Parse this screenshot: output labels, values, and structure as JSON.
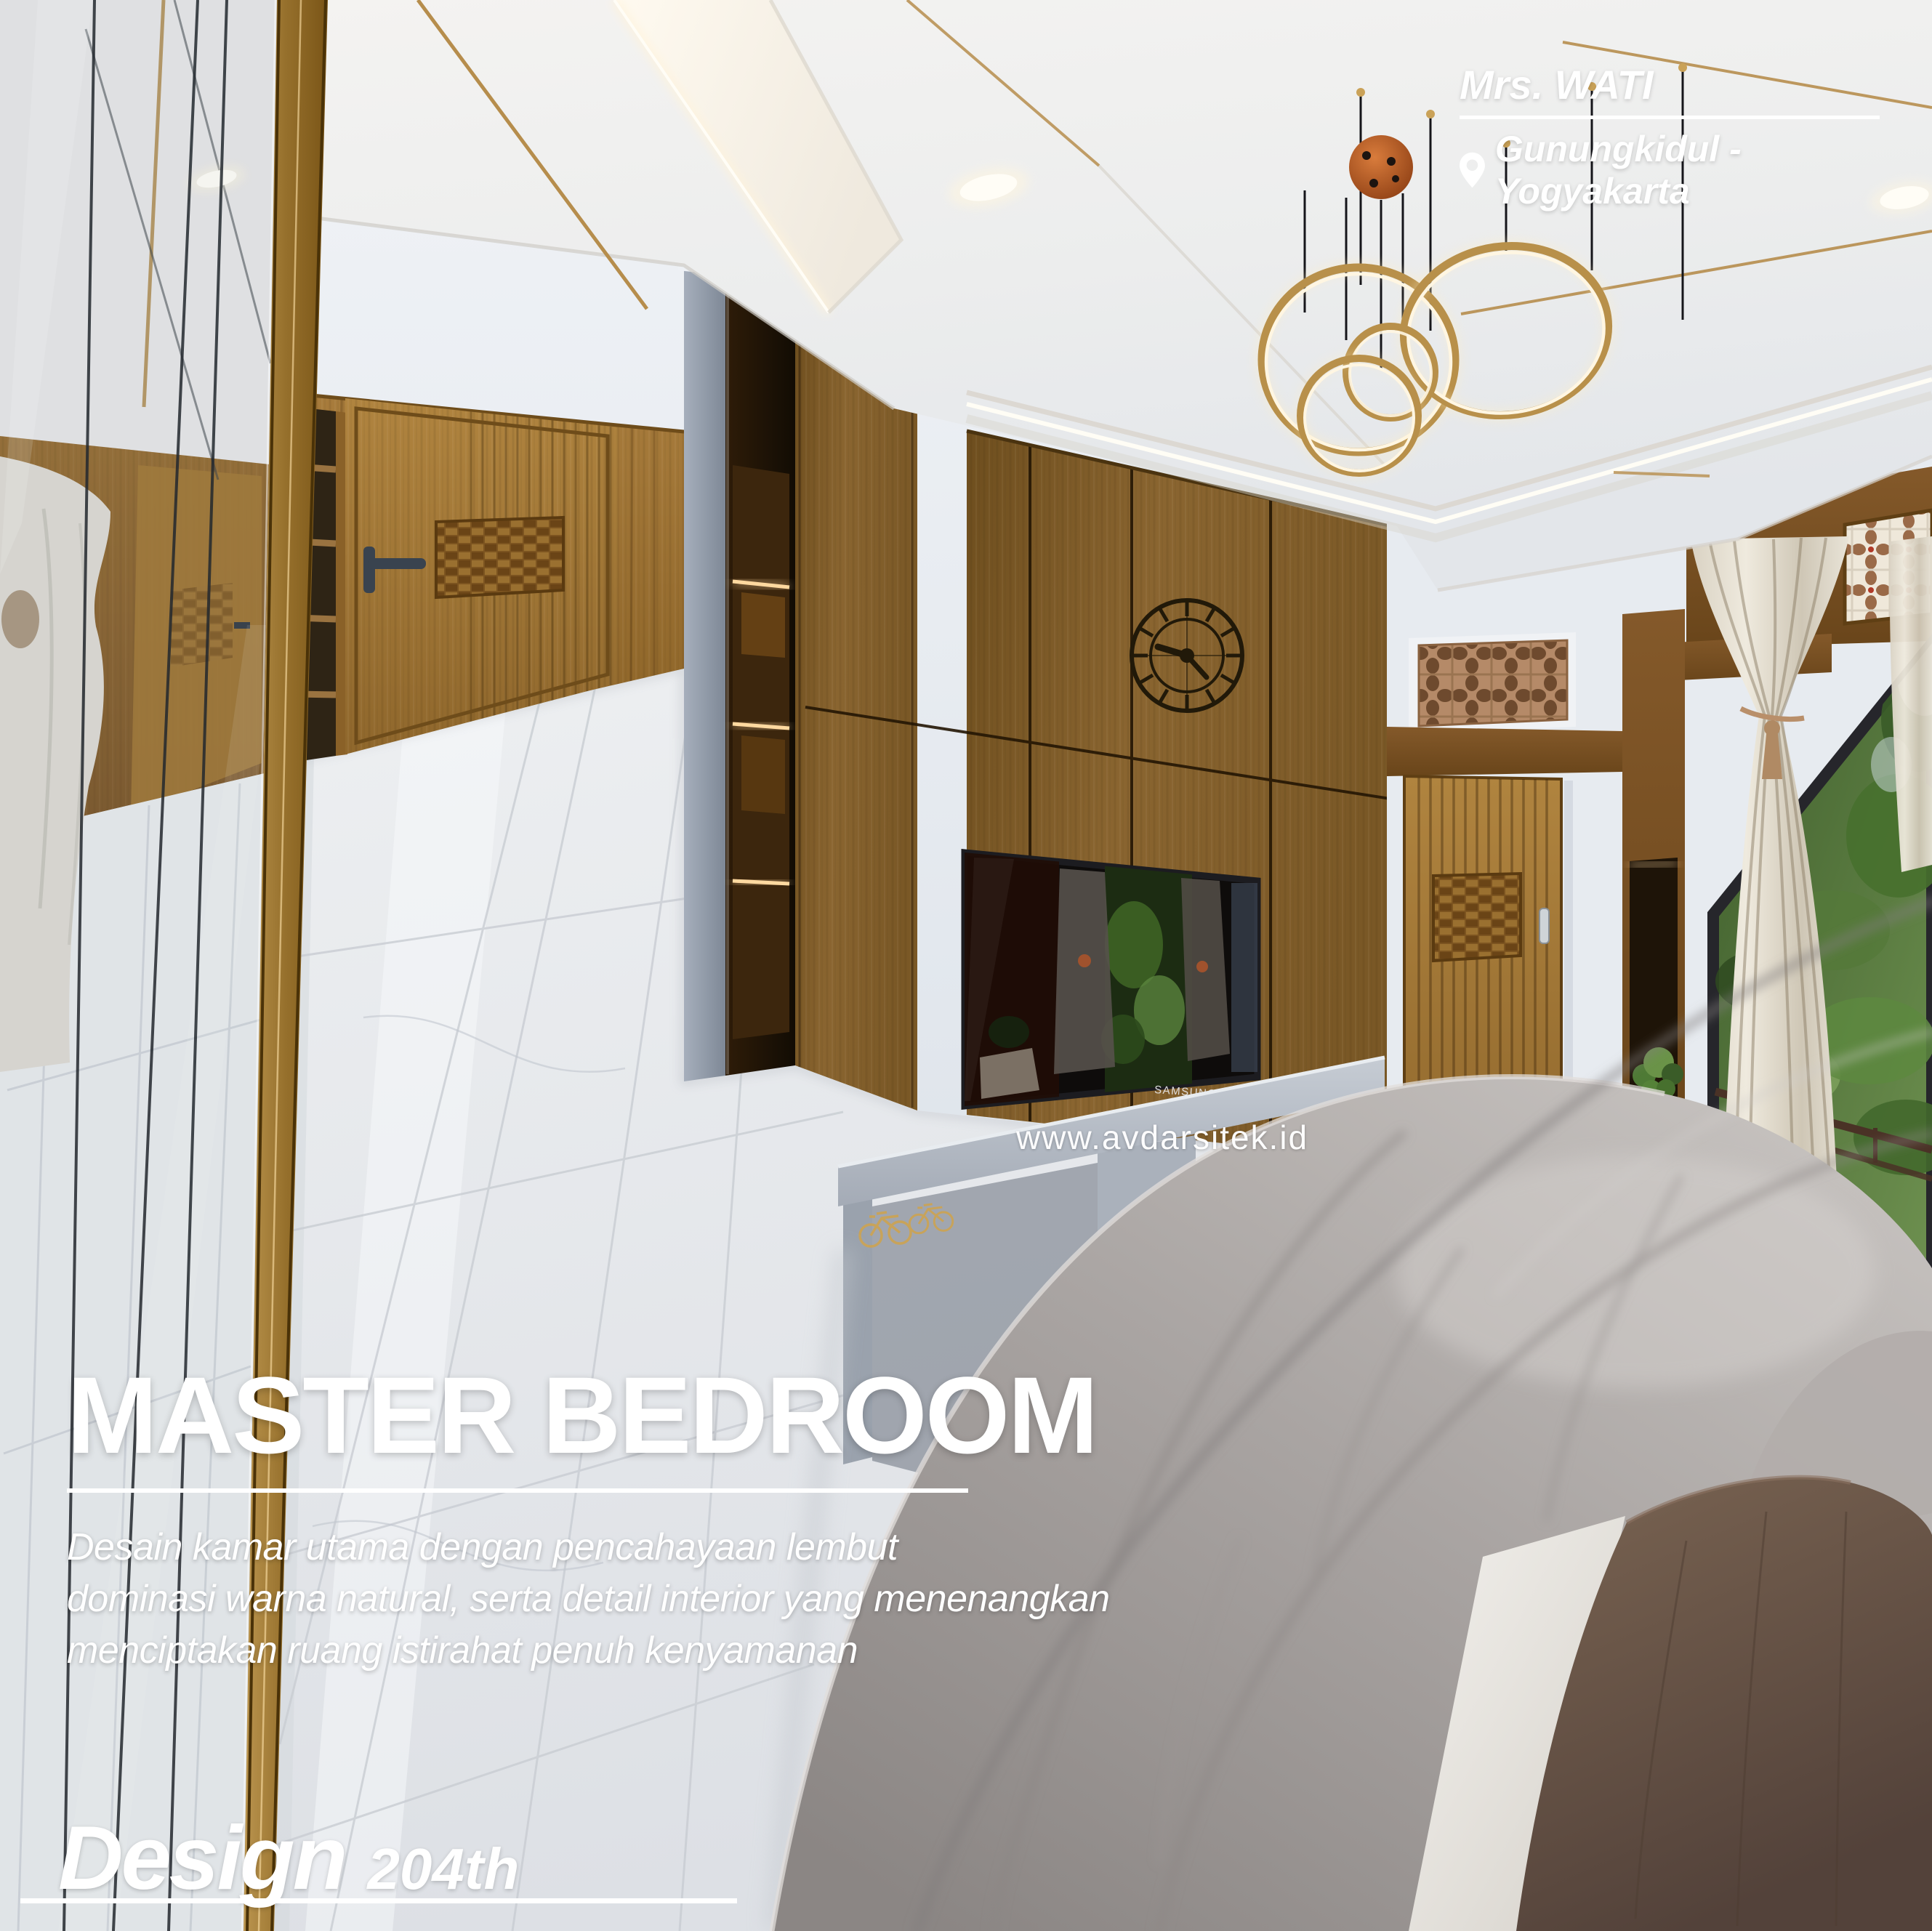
{
  "poster": {
    "client": {
      "name": "Mrs. WATI",
      "location": "Gunungkidul - Yogyakarta"
    },
    "watermark": "www.avdarsitek.id",
    "title": "MASTER BEDROOM",
    "description_lines": [
      "Desain kamar utama dengan pencahayaan lembut",
      "dominasi warna natural, serta detail interior yang menenangkan",
      "menciptakan ruang istirahat penuh kenyamanan"
    ],
    "design_label": "Design",
    "design_number": "204th"
  },
  "scene": {
    "tv_brand": "SAMSUNG",
    "colors": {
      "wood": "#8a6330",
      "gold_accent": "#c9a050",
      "wall_white": "#e8ecf1",
      "bedding_gray": "#a9a4a2",
      "overlay_text": "#ffffff"
    }
  }
}
